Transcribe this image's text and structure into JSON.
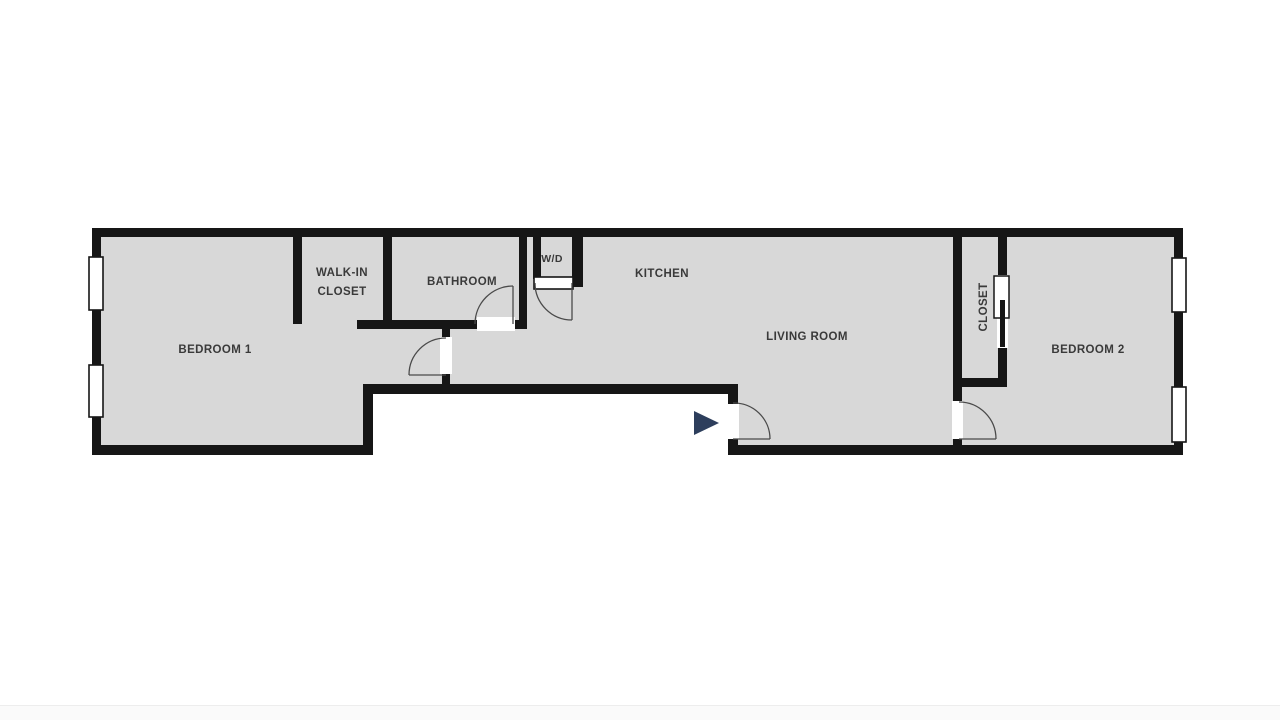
{
  "floor_plan": {
    "labels": {
      "bedroom1": "BEDROOM 1",
      "walk_in_closet_line1": "WALK-IN",
      "walk_in_closet_line2": "CLOSET",
      "bathroom": "BATHROOM",
      "washer_dryer": "W/D",
      "kitchen": "KITCHEN",
      "living_room": "LIVING ROOM",
      "closet": "CLOSET",
      "bedroom2": "BEDROOM 2"
    },
    "colors": {
      "background": "#ffffff",
      "floor": "#d8d8d8",
      "wall": "#161616",
      "label_text": "#3a3a3a",
      "door_arc": "#4a4a4a",
      "entrance_arrow": "#2d3e5c",
      "footer_strip": "#fafafa",
      "footer_border": "#ededed"
    },
    "icons": {
      "entrance_arrow": "right-pointing-triangle"
    }
  }
}
